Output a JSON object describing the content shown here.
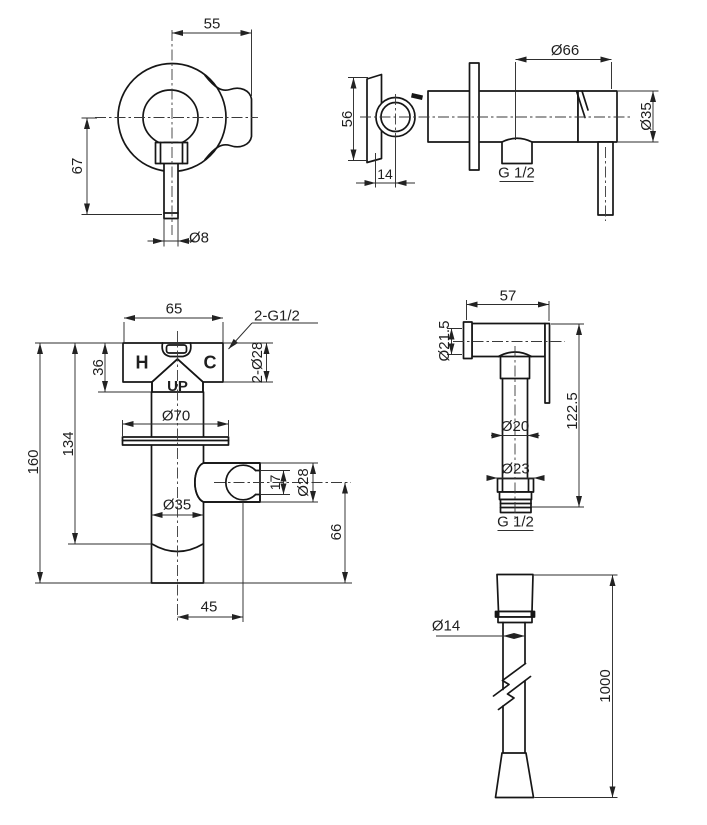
{
  "colors": {
    "background": "#ffffff",
    "line": "#161616",
    "dim_line": "#2e2e2e",
    "text": "#1f1f1f"
  },
  "views": {
    "mixer_front": {
      "width_top": "55",
      "height_left": "67",
      "handle_dia": "Ø8"
    },
    "mixer_side": {
      "escutcheon_dia": "Ø66",
      "body_dia": "Ø35",
      "depth": "56",
      "flange_depth": "14",
      "outlet_thread": "G 1/2"
    },
    "valve_front": {
      "width_top": "65",
      "inlet_threads": "2-G1/2",
      "hot": "H",
      "cold": "C",
      "up": "UP",
      "plate_height": "36",
      "trim_dia": "2-Ø28",
      "flange_dia": "Ø70",
      "body_dia": "Ø35",
      "total_height": "160",
      "body_height": "134",
      "slot_height": "17",
      "holder_dia": "Ø28",
      "holder_height": "66",
      "holder_offset": "45"
    },
    "sprayer": {
      "head_length": "57",
      "head_dia": "Ø21.5",
      "total_height": "122.5",
      "grip_dia": "Ø20",
      "nut_dia": "Ø23",
      "thread": "G 1/2"
    },
    "hose": {
      "dia": "Ø14",
      "length": "1000"
    }
  }
}
